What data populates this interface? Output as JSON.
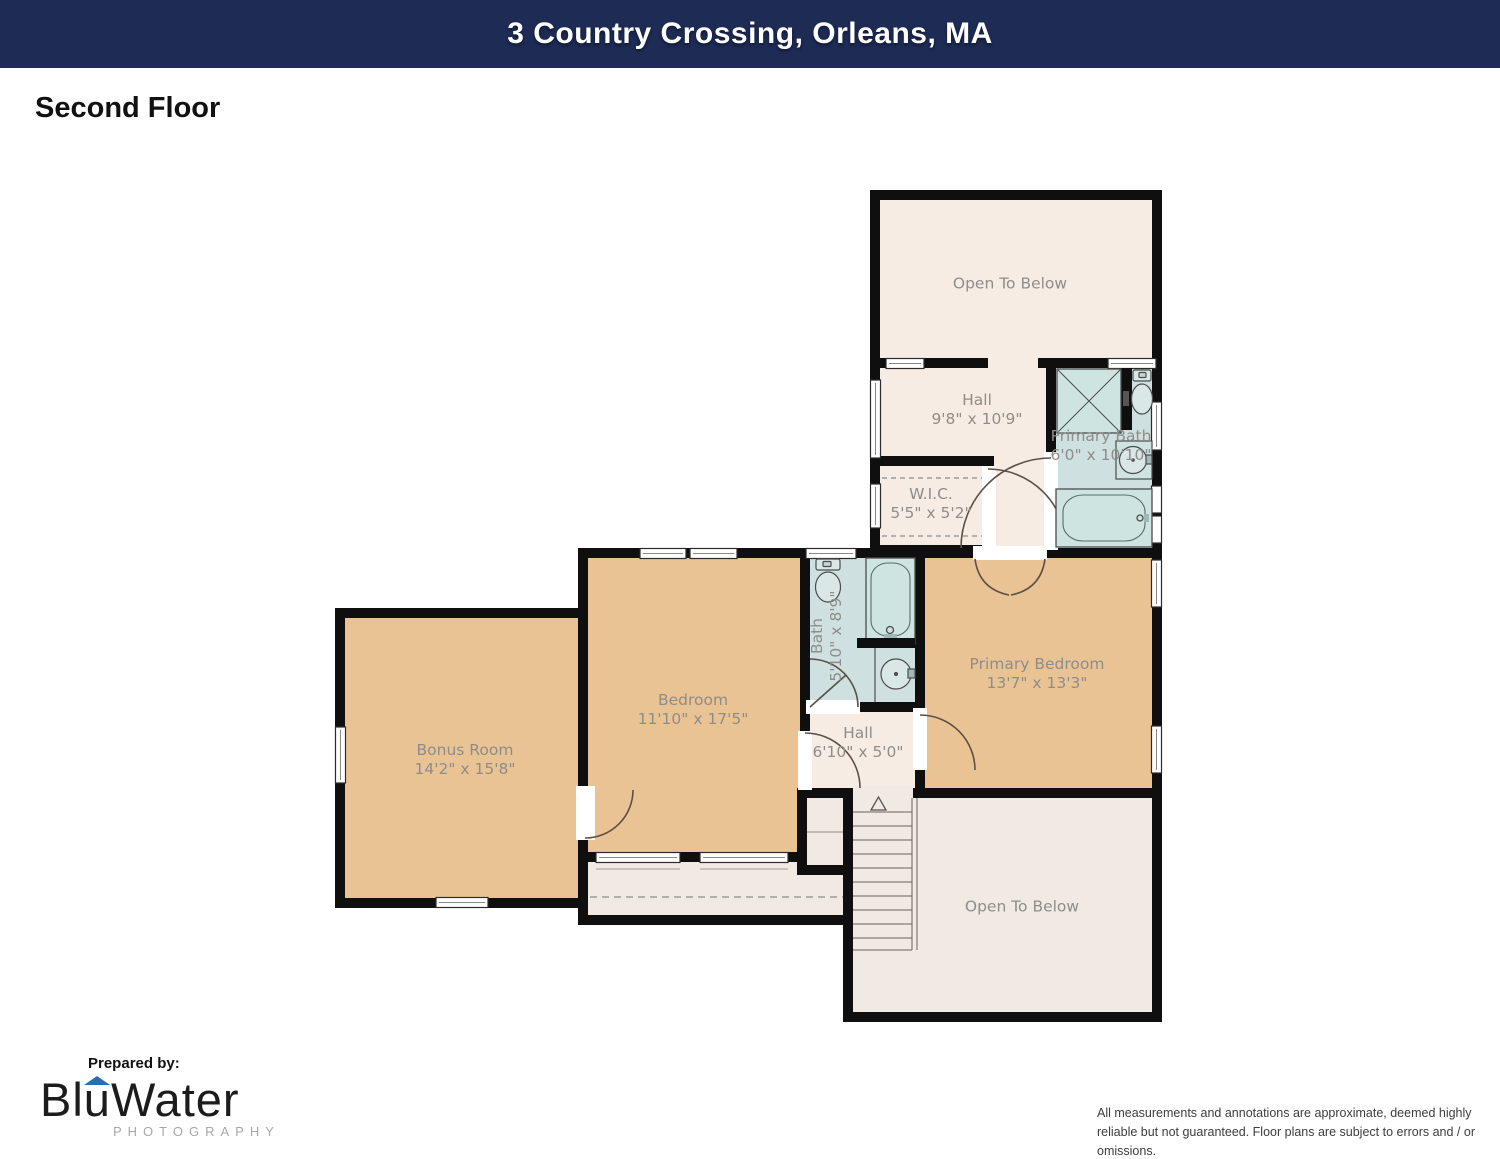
{
  "header": {
    "title": "3 Country Crossing, Orleans, MA"
  },
  "floor_label": "Second Floor",
  "rooms": {
    "open_to_below_top": {
      "name": "Open To Below"
    },
    "hall_upper": {
      "name": "Hall",
      "dims": "9'8\" x 10'9\""
    },
    "primary_bath": {
      "name": "Primary Bath",
      "dims": "6'0\" x 10'10\""
    },
    "wic": {
      "name": "W.I.C.",
      "dims": "5'5\" x 5'2\""
    },
    "bedroom": {
      "name": "Bedroom",
      "dims": "11'10\" x 17'5\""
    },
    "bath": {
      "name": "Bath",
      "dims": "5'10\" x 8'9\""
    },
    "primary_bedroom": {
      "name": "Primary Bedroom",
      "dims": "13'7\" x 13'3\""
    },
    "hall_lower": {
      "name": "Hall",
      "dims": "6'10\" x 5'0\""
    },
    "bonus_room": {
      "name": "Bonus Room",
      "dims": "14'2\" x 15'8\""
    },
    "open_to_below_bottom": {
      "name": "Open To Below"
    }
  },
  "footer": {
    "prepared_by": "Prepared by:",
    "logo": {
      "p1": "Bl",
      "p2": "u",
      "p3": "Water",
      "sub": "PHOTOGRAPHY"
    },
    "disclaimer": "All measurements and annotations are approximate, deemed highly reliable but not guaranteed. Floor plans are subject to errors and / or omissions."
  },
  "colors": {
    "header_bg": "#1d2b55",
    "wall": "#0f0f0f",
    "room_tan": "#eac394",
    "room_blue": "#cfe0e0",
    "room_cream": "#f7ece4",
    "room_light": "#f1eae3",
    "label_gray": "#8e8d8b",
    "logo_blue": "#2a6db0"
  }
}
